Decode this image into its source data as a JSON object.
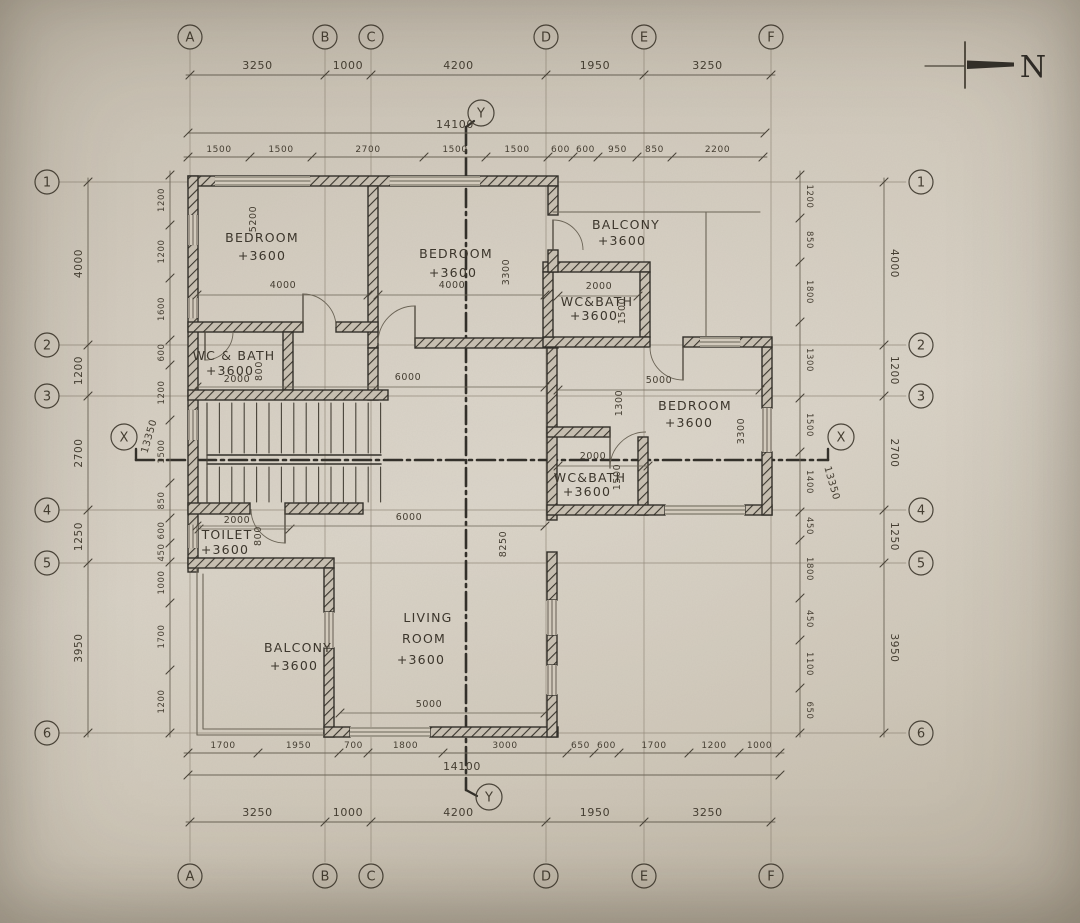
{
  "drawing": {
    "north_label": "N",
    "grid_letters": [
      "A",
      "B",
      "C",
      "D",
      "E",
      "F"
    ],
    "grid_numbers": [
      "1",
      "2",
      "3",
      "4",
      "5",
      "6"
    ],
    "axis_x_label": "X",
    "axis_y_label": "Y",
    "dims": {
      "top_outer": [
        "3250",
        "1000",
        "4200",
        "1950",
        "3250"
      ],
      "top_total": "14100",
      "top_inner": [
        "1500",
        "1500",
        "2700",
        "1500",
        "1500",
        "600",
        "600",
        "950",
        "850",
        "2200"
      ],
      "bottom_inner": [
        "1700",
        "1950",
        "700",
        "1800",
        "3000",
        "650",
        "600",
        "1700",
        "1200",
        "1000"
      ],
      "bottom_total": "14100",
      "bottom_outer": [
        "3250",
        "1000",
        "4200",
        "1950",
        "3250"
      ],
      "left_outer": [
        "4000",
        "1200",
        "2700",
        "1250",
        "3950"
      ],
      "left_inner": [
        "1200",
        "1200",
        "1600",
        "600",
        "1200",
        "1500",
        "850",
        "600",
        "450",
        "1000",
        "1700",
        "1200"
      ],
      "right_outer": [
        "4000",
        "1200",
        "2700",
        "1250",
        "3950"
      ],
      "right_inner": [
        "1200",
        "850",
        "1800",
        "1300",
        "1500",
        "1400",
        "450",
        "1800",
        "450",
        "1100",
        "650"
      ],
      "x_line_left": "13350",
      "x_line_right": "13350"
    },
    "interior_dims": [
      "5200",
      "4000",
      "4000",
      "3300",
      "2000",
      "1500",
      "2000",
      "800",
      "6000",
      "5000",
      "1300",
      "3300",
      "2000",
      "1500",
      "2000",
      "800",
      "6000",
      "8250",
      "5000"
    ],
    "rooms": [
      {
        "lines": [
          "BEDROOM",
          "+3600"
        ]
      },
      {
        "lines": [
          "BEDROOM",
          "+3600"
        ]
      },
      {
        "lines": [
          "BALCONY",
          "+3600"
        ]
      },
      {
        "lines": [
          "WC&BATH",
          "+3600"
        ]
      },
      {
        "lines": [
          "BEDROOM",
          "+3600"
        ]
      },
      {
        "lines": [
          "WC&BATH",
          "+3600"
        ]
      },
      {
        "lines": [
          "WC & BATH",
          "+3600"
        ]
      },
      {
        "lines": [
          "TOILET",
          "+3600"
        ]
      },
      {
        "lines": [
          "BALCONY",
          "+3600"
        ]
      },
      {
        "lines": [
          "LIVING",
          "ROOM",
          "+3600"
        ]
      }
    ]
  }
}
